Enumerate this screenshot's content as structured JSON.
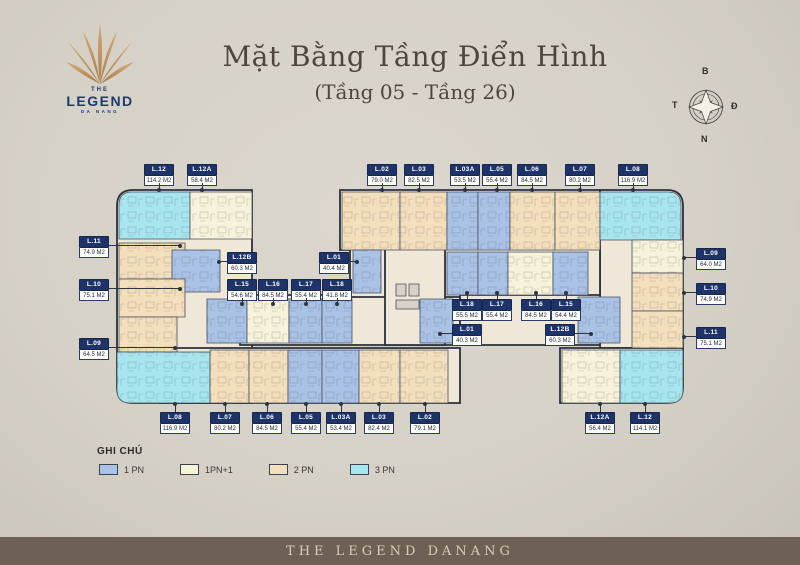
{
  "header": {
    "logo": {
      "the": "THE",
      "name": "LEGEND",
      "city": "DA NANG"
    },
    "title": "Mặt Bằng Tầng Điển Hình",
    "subtitle": "(Tầng 05 - Tầng 26)",
    "compass": {
      "north": "B",
      "east": "Đ",
      "south": "N",
      "west": "T"
    }
  },
  "legend": {
    "title": "GHI CHÚ",
    "items": [
      {
        "label": "1 PN",
        "color": "#aac2e6"
      },
      {
        "label": "1PN+1",
        "color": "#f7f3da"
      },
      {
        "label": "2 PN",
        "color": "#f4dfbc"
      },
      {
        "label": "3 PN",
        "color": "#a7e6ee"
      }
    ]
  },
  "footer": {
    "text": "THE LEGEND DANANG"
  },
  "plan": {
    "colors": {
      "slab": "#efe8d8",
      "1pn": "#aac2e6",
      "1pn1": "#f7f3da",
      "2pn": "#f4dfbc",
      "3pn": "#a7e6ee",
      "lift": "#d8d2c4"
    },
    "shapes": [
      {
        "n": "wing-left",
        "t": "slab",
        "x": 117,
        "y": 190,
        "w": 135,
        "h": 213,
        "rc": [
          "tl",
          "bl"
        ]
      },
      {
        "n": "bar-top",
        "t": "slab",
        "x": 340,
        "y": 190,
        "w": 260,
        "h": 60
      },
      {
        "n": "wing-right",
        "t": "slab",
        "x": 600,
        "y": 190,
        "w": 83,
        "h": 158,
        "rc": [
          "tr"
        ]
      },
      {
        "n": "bar-bottom",
        "t": "slab",
        "x": 160,
        "y": 348,
        "w": 300,
        "h": 55
      },
      {
        "n": "block-bottom-right",
        "t": "slab",
        "x": 560,
        "y": 348,
        "w": 123,
        "h": 55,
        "rc": [
          "br"
        ]
      },
      {
        "n": "mid-left",
        "t": "slab",
        "x": 240,
        "y": 295,
        "w": 220,
        "h": 50
      },
      {
        "n": "mid-right",
        "t": "slab",
        "x": 350,
        "y": 247,
        "w": 250,
        "h": 50
      },
      {
        "n": "core-center",
        "t": "slab",
        "x": 385,
        "y": 247,
        "w": 60,
        "h": 98
      },
      {
        "n": "mid-right-lower",
        "t": "slab",
        "x": 460,
        "y": 295,
        "w": 140,
        "h": 50
      },
      {
        "n": "unit-l12-top",
        "t": "3pn",
        "x": 119,
        "y": 192,
        "w": 71,
        "h": 47,
        "rc": [
          "tl"
        ]
      },
      {
        "n": "unit-l12a-top",
        "t": "1pn1",
        "x": 190,
        "y": 192,
        "w": 62,
        "h": 47
      },
      {
        "n": "unit-l11-left",
        "t": "2pn",
        "x": 119,
        "y": 243,
        "w": 66,
        "h": 36
      },
      {
        "n": "unit-l12b-left",
        "t": "1pn",
        "x": 172,
        "y": 250,
        "w": 48,
        "h": 42
      },
      {
        "n": "unit-l10-left",
        "t": "2pn",
        "x": 119,
        "y": 279,
        "w": 66,
        "h": 38
      },
      {
        "n": "unit-l09-left",
        "t": "2pn",
        "x": 119,
        "y": 317,
        "w": 58,
        "h": 35
      },
      {
        "n": "unit-l08-bottom-left",
        "t": "3pn",
        "x": 117,
        "y": 352,
        "w": 93,
        "h": 51,
        "rc": [
          "bl"
        ]
      },
      {
        "n": "unit-l02-top",
        "t": "2pn",
        "x": 342,
        "y": 192,
        "w": 58,
        "h": 58
      },
      {
        "n": "unit-l03-top",
        "t": "2pn",
        "x": 400,
        "y": 192,
        "w": 47,
        "h": 58
      },
      {
        "n": "unit-l03a-top",
        "t": "1pn",
        "x": 447,
        "y": 192,
        "w": 31,
        "h": 58
      },
      {
        "n": "unit-l05-top",
        "t": "1pn",
        "x": 478,
        "y": 192,
        "w": 32,
        "h": 58
      },
      {
        "n": "unit-l06-top",
        "t": "2pn",
        "x": 510,
        "y": 192,
        "w": 45,
        "h": 58
      },
      {
        "n": "unit-l07-top",
        "t": "2pn",
        "x": 555,
        "y": 192,
        "w": 45,
        "h": 58
      },
      {
        "n": "unit-l08-top-right",
        "t": "3pn",
        "x": 600,
        "y": 192,
        "w": 81,
        "h": 48,
        "rc": [
          "tr"
        ]
      },
      {
        "n": "unit-l09-right",
        "t": "1pn1",
        "x": 632,
        "y": 240,
        "w": 51,
        "h": 33
      },
      {
        "n": "unit-l10-right",
        "t": "2pn",
        "x": 632,
        "y": 273,
        "w": 51,
        "h": 38
      },
      {
        "n": "unit-l11-right",
        "t": "2pn",
        "x": 632,
        "y": 311,
        "w": 51,
        "h": 37
      },
      {
        "n": "unit-l01-left",
        "t": "1pn",
        "x": 353,
        "y": 250,
        "w": 28,
        "h": 43
      },
      {
        "n": "unit-l18-right",
        "t": "1pn",
        "x": 447,
        "y": 252,
        "w": 31,
        "h": 43
      },
      {
        "n": "unit-l17-right",
        "t": "1pn",
        "x": 478,
        "y": 252,
        "w": 30,
        "h": 43
      },
      {
        "n": "unit-l16-right",
        "t": "1pn1",
        "x": 508,
        "y": 252,
        "w": 45,
        "h": 43
      },
      {
        "n": "unit-l15-right",
        "t": "1pn",
        "x": 553,
        "y": 252,
        "w": 35,
        "h": 43
      },
      {
        "n": "unit-l15-left",
        "t": "1pn",
        "x": 207,
        "y": 299,
        "w": 40,
        "h": 44
      },
      {
        "n": "unit-l16-left",
        "t": "1pn1",
        "x": 247,
        "y": 299,
        "w": 42,
        "h": 44
      },
      {
        "n": "unit-l17-left",
        "t": "1pn",
        "x": 289,
        "y": 299,
        "w": 33,
        "h": 44
      },
      {
        "n": "unit-l18-left",
        "t": "1pn",
        "x": 322,
        "y": 299,
        "w": 30,
        "h": 44
      },
      {
        "n": "unit-l01-right",
        "t": "1pn",
        "x": 420,
        "y": 299,
        "w": 33,
        "h": 44
      },
      {
        "n": "unit-l12b-right",
        "t": "1pn",
        "x": 578,
        "y": 297,
        "w": 42,
        "h": 46
      },
      {
        "n": "unit-l07-bottom",
        "t": "2pn",
        "x": 210,
        "y": 350,
        "w": 39,
        "h": 53
      },
      {
        "n": "unit-l06-bottom",
        "t": "2pn",
        "x": 249,
        "y": 350,
        "w": 39,
        "h": 53
      },
      {
        "n": "unit-l05-bottom",
        "t": "1pn",
        "x": 288,
        "y": 350,
        "w": 34,
        "h": 53
      },
      {
        "n": "unit-l03a-bottom",
        "t": "1pn",
        "x": 322,
        "y": 350,
        "w": 37,
        "h": 53
      },
      {
        "n": "unit-l03-bottom",
        "t": "2pn",
        "x": 359,
        "y": 350,
        "w": 41,
        "h": 53
      },
      {
        "n": "unit-l02-bottom",
        "t": "2pn",
        "x": 400,
        "y": 350,
        "w": 48,
        "h": 53
      },
      {
        "n": "unit-l12a-bottom",
        "t": "1pn1",
        "x": 562,
        "y": 350,
        "w": 58,
        "h": 53
      },
      {
        "n": "unit-l12-bottom",
        "t": "3pn",
        "x": 620,
        "y": 350,
        "w": 63,
        "h": 53,
        "rc": [
          "br"
        ]
      },
      {
        "n": "lift-1",
        "t": "lift",
        "x": 396,
        "y": 284,
        "w": 10,
        "h": 12
      },
      {
        "n": "lift-2",
        "t": "lift",
        "x": 409,
        "y": 284,
        "w": 10,
        "h": 12
      },
      {
        "n": "stair-core",
        "t": "lift",
        "x": 396,
        "y": 300,
        "w": 23,
        "h": 9
      }
    ],
    "labels": [
      {
        "unit": "L.12",
        "area": "114.2 M2",
        "x": 159,
        "y": 164,
        "dir": "down",
        "len": 6
      },
      {
        "unit": "L.12A",
        "area": "58.4 M2",
        "x": 202,
        "y": 164,
        "dir": "down",
        "len": 6
      },
      {
        "unit": "L.02",
        "area": "79.0 M2",
        "x": 382,
        "y": 164,
        "dir": "down",
        "len": 6
      },
      {
        "unit": "L.03",
        "area": "82.5 M2",
        "x": 419,
        "y": 164,
        "dir": "down",
        "len": 6
      },
      {
        "unit": "L.03A",
        "area": "53.5 M2",
        "x": 465,
        "y": 164,
        "dir": "down",
        "len": 6
      },
      {
        "unit": "L.05",
        "area": "55.4 M2",
        "x": 497,
        "y": 164,
        "dir": "down",
        "len": 6
      },
      {
        "unit": "L.06",
        "area": "84.5 M2",
        "x": 532,
        "y": 164,
        "dir": "down",
        "len": 6
      },
      {
        "unit": "L.07",
        "area": "80.2 M2",
        "x": 580,
        "y": 164,
        "dir": "down",
        "len": 6
      },
      {
        "unit": "L.08",
        "area": "116.9 M2",
        "x": 633,
        "y": 164,
        "dir": "down",
        "len": 6
      },
      {
        "unit": "L.11",
        "area": "74.9 M2",
        "x": 94,
        "y": 236,
        "dir": "right",
        "len": 71
      },
      {
        "unit": "L.10",
        "area": "75.1 M2",
        "x": 94,
        "y": 279,
        "dir": "right",
        "len": 71
      },
      {
        "unit": "L.09",
        "area": "64.5 M2",
        "x": 94,
        "y": 338,
        "dir": "right",
        "len": 66
      },
      {
        "unit": "L.09",
        "area": "64.0 M2",
        "x": 711,
        "y": 248,
        "dir": "left",
        "len": 12
      },
      {
        "unit": "L.10",
        "area": "74.9 M2",
        "x": 711,
        "y": 283,
        "dir": "left",
        "len": 12
      },
      {
        "unit": "L.11",
        "area": "75.1 M2",
        "x": 711,
        "y": 327,
        "dir": "left",
        "len": 12
      },
      {
        "unit": "L.12B",
        "area": "60.3 M2",
        "x": 242,
        "y": 252,
        "dir": "left",
        "len": 8
      },
      {
        "unit": "L.01",
        "area": "40.4 M2",
        "x": 334,
        "y": 252,
        "dir": "right",
        "len": 8
      },
      {
        "unit": "L.15",
        "area": "54.6 M2",
        "x": 242,
        "y": 279,
        "dir": "down",
        "len": 5
      },
      {
        "unit": "L.16",
        "area": "84.5 M2",
        "x": 273,
        "y": 279,
        "dir": "down",
        "len": 5
      },
      {
        "unit": "L.17",
        "area": "55.4 M2",
        "x": 306,
        "y": 279,
        "dir": "down",
        "len": 5
      },
      {
        "unit": "L.18",
        "area": "41.8 M2",
        "x": 337,
        "y": 279,
        "dir": "down",
        "len": 5
      },
      {
        "unit": "L.18",
        "area": "55.5 M2",
        "x": 467,
        "y": 299,
        "dir": "up",
        "len": 5
      },
      {
        "unit": "L.17",
        "area": "55.4 M2",
        "x": 497,
        "y": 299,
        "dir": "up",
        "len": 5
      },
      {
        "unit": "L.16",
        "area": "84.5 M2",
        "x": 536,
        "y": 299,
        "dir": "up",
        "len": 5
      },
      {
        "unit": "L.15",
        "area": "54.4 M2",
        "x": 566,
        "y": 299,
        "dir": "up",
        "len": 5
      },
      {
        "unit": "L.01",
        "area": "40.3 M2",
        "x": 467,
        "y": 324,
        "dir": "left",
        "len": 12
      },
      {
        "unit": "L.12B",
        "area": "60.3 M2",
        "x": 560,
        "y": 324,
        "dir": "right",
        "len": 16
      },
      {
        "unit": "L.08",
        "area": "116.9 M2",
        "x": 175,
        "y": 412,
        "dir": "up",
        "len": 7
      },
      {
        "unit": "L.07",
        "area": "80.2 M2",
        "x": 225,
        "y": 412,
        "dir": "up",
        "len": 7
      },
      {
        "unit": "L.06",
        "area": "84.5 M2",
        "x": 267,
        "y": 412,
        "dir": "up",
        "len": 7
      },
      {
        "unit": "L.05",
        "area": "55.4 M2",
        "x": 306,
        "y": 412,
        "dir": "up",
        "len": 7
      },
      {
        "unit": "L.03A",
        "area": "53.4 M2",
        "x": 341,
        "y": 412,
        "dir": "up",
        "len": 7
      },
      {
        "unit": "L.03",
        "area": "82.4 M2",
        "x": 379,
        "y": 412,
        "dir": "up",
        "len": 7
      },
      {
        "unit": "L.02",
        "area": "79.1 M2",
        "x": 425,
        "y": 412,
        "dir": "up",
        "len": 7
      },
      {
        "unit": "L.12A",
        "area": "56.4 M2",
        "x": 600,
        "y": 412,
        "dir": "up",
        "len": 7
      },
      {
        "unit": "L.12",
        "area": "114.1 M2",
        "x": 645,
        "y": 412,
        "dir": "up",
        "len": 7
      }
    ]
  }
}
